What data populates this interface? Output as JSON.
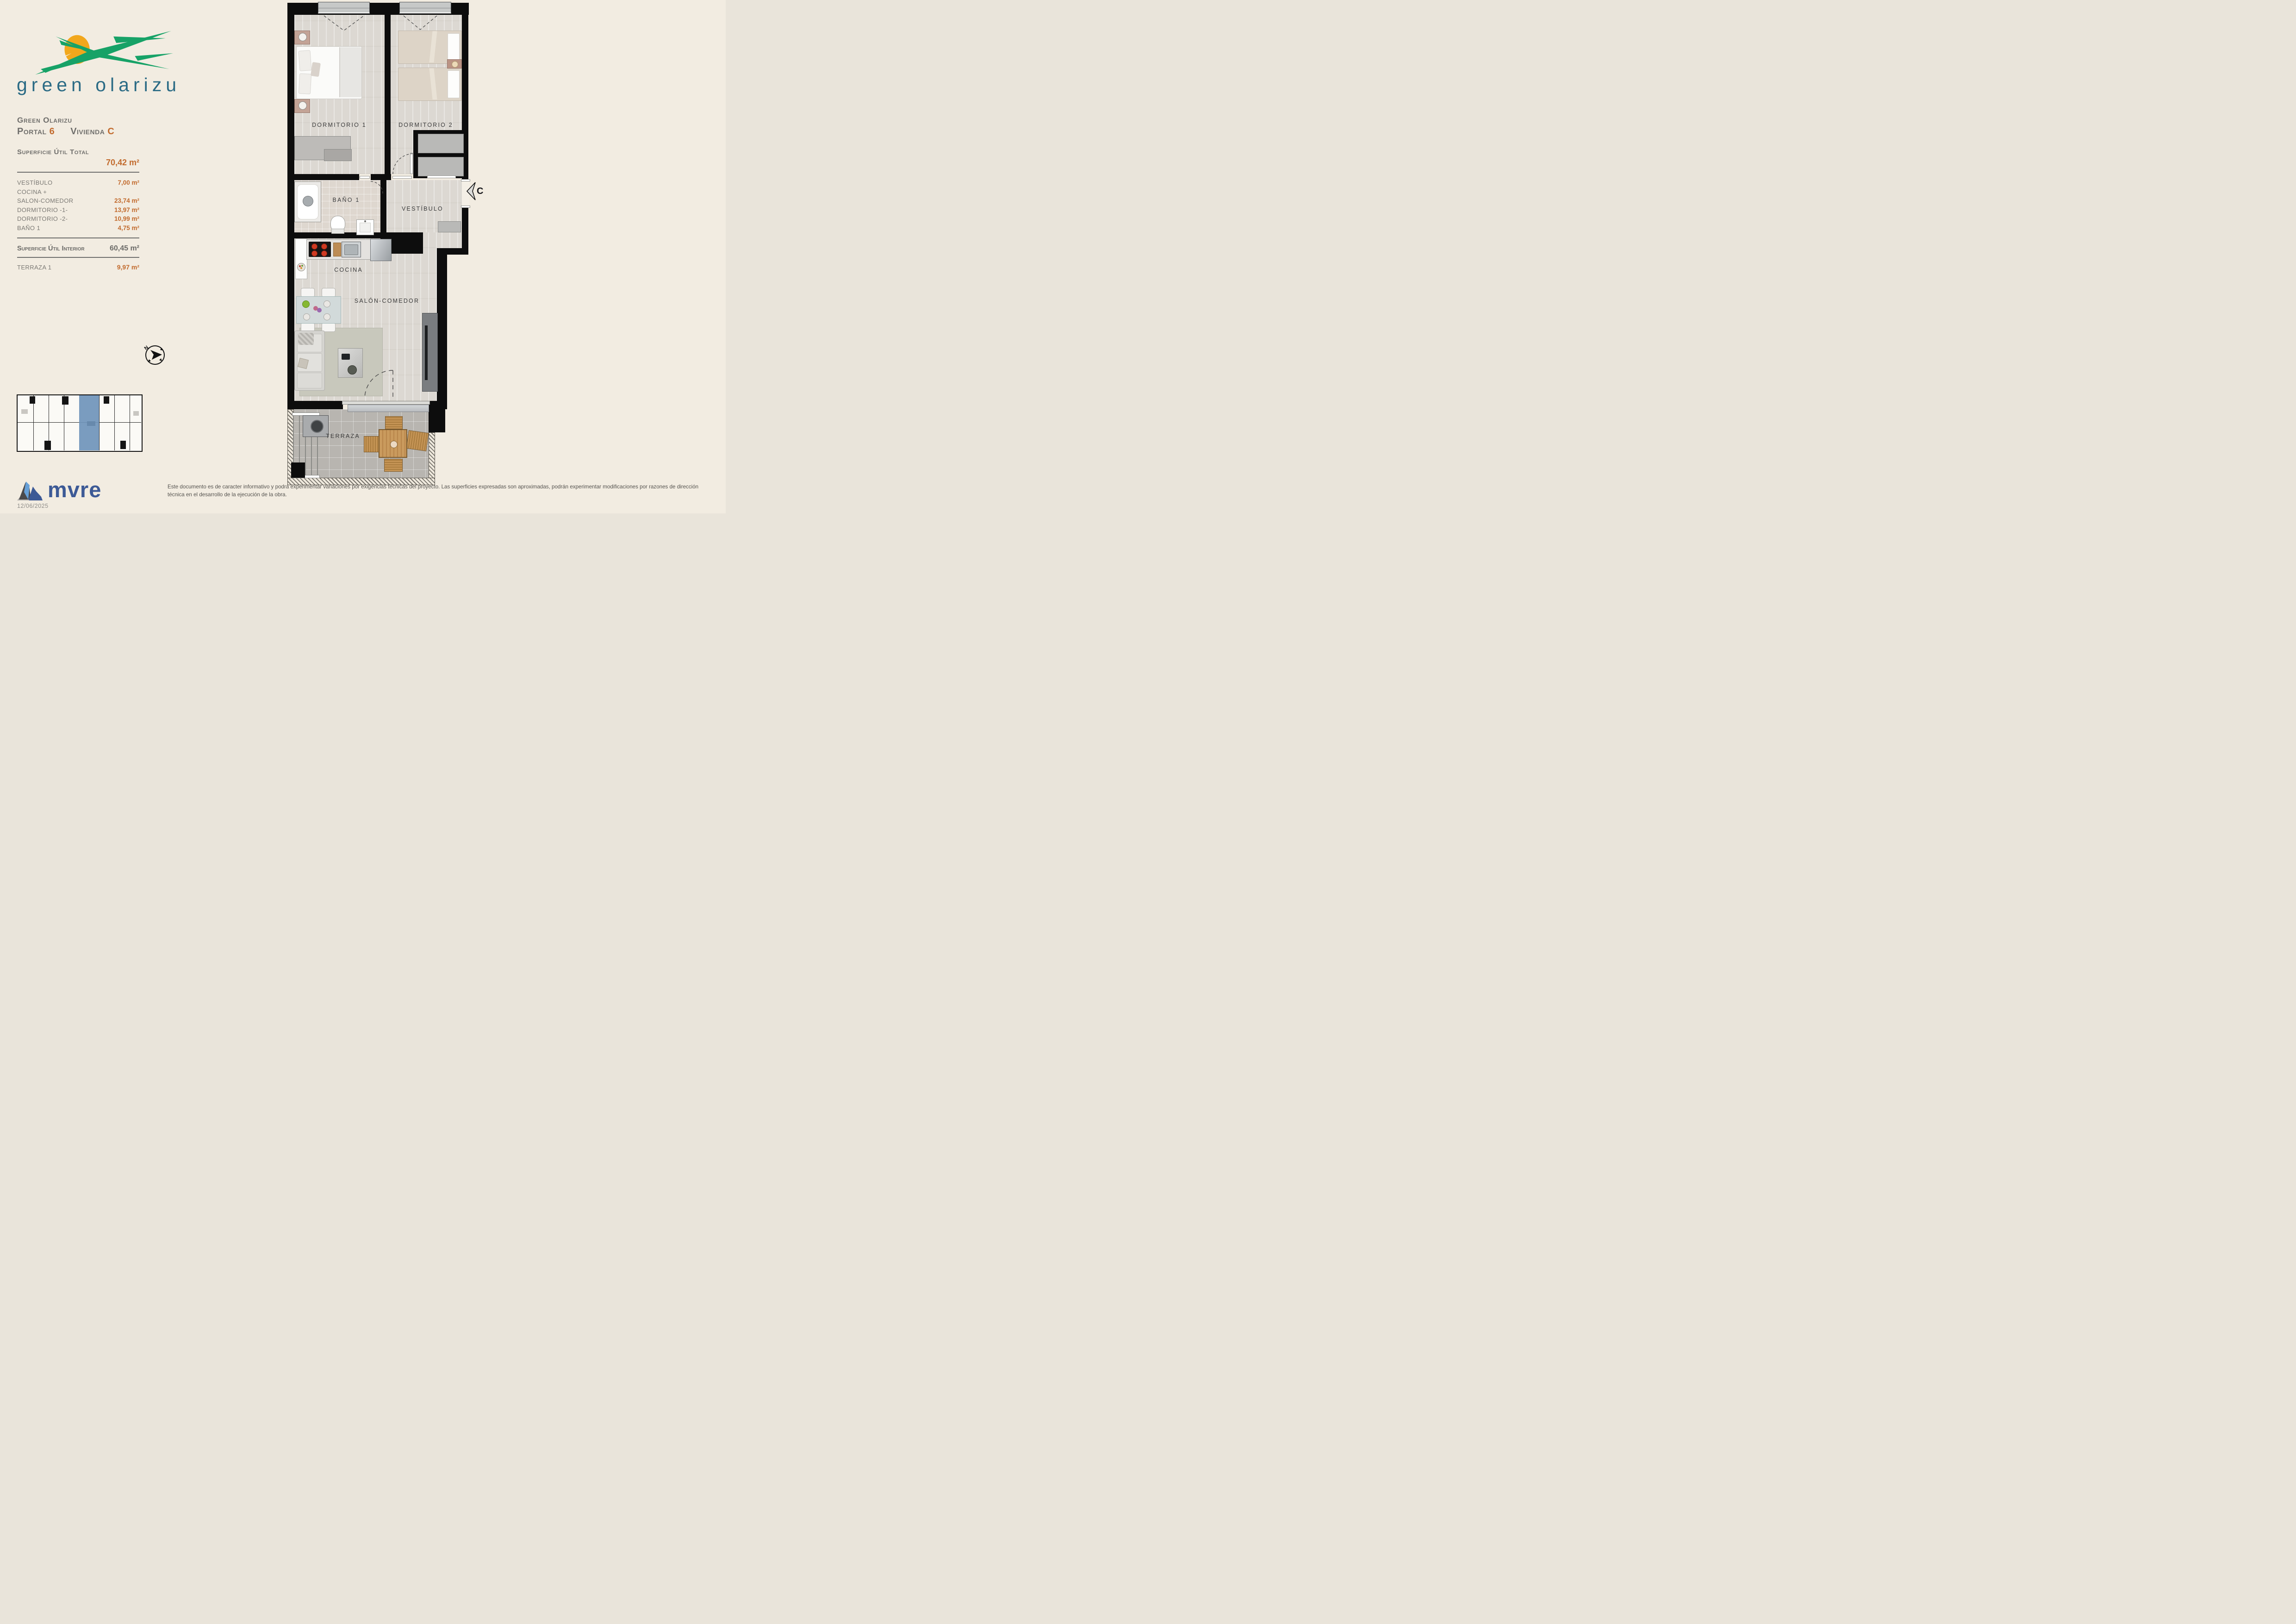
{
  "page": {
    "background": "#f2ece1"
  },
  "logo": {
    "wordmark": "green olarizu",
    "green": "#17a267",
    "sun": "#f2a71c",
    "text_color": "#2b6b85"
  },
  "sidebar": {
    "project": "Green Olarizu",
    "portal_label": "Portal",
    "portal_value": "6",
    "vivienda_label": "Vivienda",
    "vivienda_value": "C",
    "total_label": "Superficie Útil Total",
    "total_value": "70,42 m²",
    "rooms": [
      {
        "label": "VESTÍBULO",
        "value": "7,00 m²"
      },
      {
        "label": "COCINA +",
        "value": ""
      },
      {
        "label": "SALON-COMEDOR",
        "value": "23,74 m²"
      },
      {
        "label": "DORMITORIO -1-",
        "value": "13,97 m²"
      },
      {
        "label": "DORMITORIO -2-",
        "value": "10,99 m²"
      },
      {
        "label": "BAÑO 1",
        "value": "4,75 m²"
      }
    ],
    "interior_label": "Superficie Útil Interior",
    "interior_value": "60,45 m²",
    "terrace_label": "TERRAZA 1",
    "terrace_value": "9,97 m²",
    "accent": "#c26b2e"
  },
  "plan": {
    "labels": {
      "dorm1": "DORMITORIO 1",
      "dorm2": "DORMITORIO 2",
      "bath": "BAÑO 1",
      "hall": "VESTÍBULO",
      "kitchen": "COCINA",
      "living": "SALÓN-COMEDOR",
      "terrace": "TERRAZA"
    },
    "entrance_letter": "C",
    "compass_north": "N"
  },
  "keyplan": {
    "highlight": "#6f94ba"
  },
  "footer": {
    "brand": "mvre",
    "brand_color": "#3d5a96",
    "disclaimer": "Este documento es de caracter informativo y podrá experimentar variaciones por exigencias técnicas del proyecto. Las superficies expresadas son aproximadas, podrán experimentar modificaciones por razones de dirección técnica en el desarrollo de la ejecución de la obra.",
    "date": "12/06/2025"
  }
}
